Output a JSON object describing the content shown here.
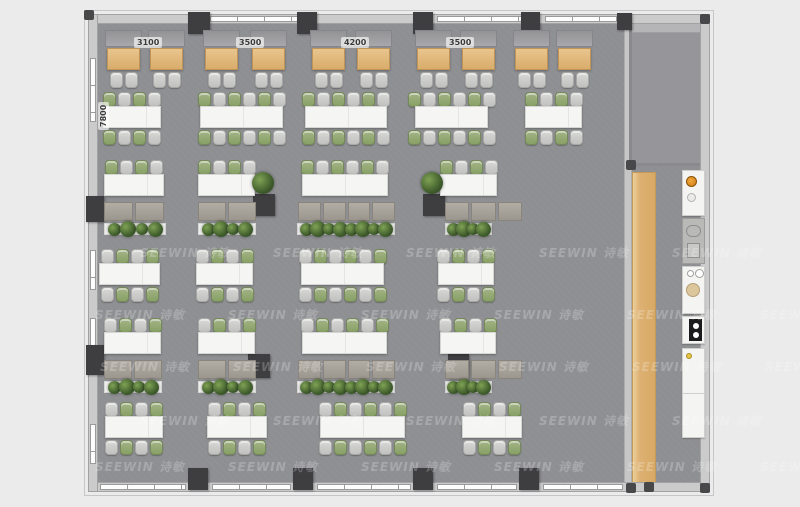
{
  "watermark": {
    "text": "SEEWIN 诗敏",
    "rows": [
      {
        "y": 244,
        "x0": 140
      },
      {
        "y": 306,
        "x0": 95
      },
      {
        "y": 358,
        "x0": 100
      },
      {
        "y": 412,
        "x0": 140
      },
      {
        "y": 458,
        "x0": 95
      }
    ],
    "step": 133,
    "count": 6
  },
  "dimensions": {
    "top": [
      {
        "label": "3100",
        "cx": 147
      },
      {
        "label": "3500",
        "cx": 249
      },
      {
        "label": "4200",
        "cx": 354
      },
      {
        "label": "3500",
        "cx": 459
      }
    ],
    "left": {
      "label": "7800",
      "x": 110,
      "y": 130
    }
  },
  "palette": {
    "floor": "#8e8f92",
    "wall": "#cbcbcb",
    "pillar": "#3e3e40",
    "wood": "#ddb377",
    "chair_green": "#8fa46c",
    "chair_gray": "#c9c9c7",
    "table_white": "#f5f5f4",
    "bench": "#a59f97",
    "watermark_color": "#ffffff"
  },
  "floorplan": {
    "building": {
      "x": 88,
      "y": 14,
      "w": 622,
      "h": 478
    },
    "room": {
      "x": 629,
      "y": 16,
      "w": 78,
      "h": 150
    },
    "bar": {
      "x": 632,
      "y": 172,
      "w": 24,
      "h": 314
    },
    "booths": {
      "benchY": 30,
      "tableY": 48,
      "chairY": 72,
      "tableW": 33,
      "tableH": 22,
      "tables": [
        107,
        150,
        205,
        252,
        312,
        357,
        417,
        462,
        515,
        558
      ]
    },
    "rows": [
      {
        "kind": "double",
        "y": 92,
        "start": "green",
        "groups": [
          {
            "x": 103,
            "w": 58,
            "seats": 4
          },
          {
            "x": 200,
            "w": 83,
            "seats": 6
          },
          {
            "x": 305,
            "w": 82,
            "seats": 6
          },
          {
            "x": 415,
            "w": 73,
            "seats": 6
          },
          {
            "x": 525,
            "w": 57,
            "seats": 4
          }
        ]
      },
      {
        "kind": "lounge",
        "y": 160,
        "start": "green",
        "groups": [
          {
            "x": 104,
            "w": 60,
            "seats": 4,
            "bench": {
              "x": 104,
              "w": 60,
              "panels": 2
            },
            "planter": {
              "x": 104,
              "w": 62,
              "plants": 4
            }
          },
          {
            "x": 198,
            "w": 57,
            "seats": 4,
            "bench": {
              "x": 198,
              "w": 58,
              "panels": 2
            },
            "planter": {
              "x": 198,
              "w": 58,
              "plants": 4
            }
          },
          {
            "x": 302,
            "w": 86,
            "seats": 6,
            "bench": {
              "x": 298,
              "w": 97,
              "panels": 4
            },
            "planter": {
              "x": 297,
              "w": 98,
              "plants": 8
            }
          },
          {
            "x": 440,
            "w": 57,
            "seats": 4,
            "bench": {
              "x": 445,
              "w": 77,
              "panels": 3
            },
            "planter": {
              "x": 445,
              "w": 47,
              "plants": 4
            }
          }
        ]
      },
      {
        "kind": "double",
        "y": 249,
        "start": "gray",
        "groups": [
          {
            "x": 99,
            "w": 61,
            "seats": 4
          },
          {
            "x": 196,
            "w": 57,
            "seats": 4
          },
          {
            "x": 301,
            "w": 83,
            "seats": 6
          },
          {
            "x": 438,
            "w": 56,
            "seats": 4
          }
        ]
      },
      {
        "kind": "lounge",
        "y": 318,
        "start": "gray",
        "groups": [
          {
            "x": 104,
            "w": 57,
            "seats": 4,
            "bench": {
              "x": 104,
              "w": 58,
              "panels": 2
            },
            "planter": {
              "x": 104,
              "w": 58,
              "plants": 4
            }
          },
          {
            "x": 198,
            "w": 57,
            "seats": 4,
            "bench": {
              "x": 198,
              "w": 58,
              "panels": 2
            },
            "planter": {
              "x": 198,
              "w": 58,
              "plants": 4
            }
          },
          {
            "x": 302,
            "w": 85,
            "seats": 6,
            "bench": {
              "x": 298,
              "w": 97,
              "panels": 4
            },
            "planter": {
              "x": 297,
              "w": 98,
              "plants": 8
            }
          },
          {
            "x": 440,
            "w": 56,
            "seats": 4,
            "bench": {
              "x": 445,
              "w": 77,
              "panels": 3
            },
            "planter": {
              "x": 445,
              "w": 47,
              "plants": 4
            }
          }
        ]
      },
      {
        "kind": "double",
        "y": 402,
        "start": "gray",
        "groups": [
          {
            "x": 105,
            "w": 58,
            "seats": 4
          },
          {
            "x": 207,
            "w": 60,
            "seats": 4
          },
          {
            "x": 320,
            "w": 85,
            "seats": 6
          },
          {
            "x": 462,
            "w": 60,
            "seats": 4
          }
        ]
      }
    ],
    "standalone_plants": [
      {
        "cx": 263,
        "cy": 183
      },
      {
        "cx": 432,
        "cy": 183
      }
    ],
    "pillars": [
      [
        188,
        12,
        22,
        22
      ],
      [
        297,
        12,
        20,
        22
      ],
      [
        413,
        12,
        20,
        22
      ],
      [
        521,
        12,
        19,
        22
      ],
      [
        617,
        13,
        15,
        17
      ],
      [
        188,
        468,
        20,
        22
      ],
      [
        293,
        468,
        20,
        22
      ],
      [
        413,
        468,
        20,
        22
      ],
      [
        519,
        468,
        20,
        22
      ],
      [
        86,
        196,
        18,
        26
      ],
      [
        86,
        345,
        18,
        30
      ],
      [
        253,
        194,
        22,
        22
      ],
      [
        423,
        194,
        22,
        22
      ],
      [
        248,
        354,
        22,
        24
      ],
      [
        448,
        354,
        21,
        24
      ]
    ],
    "corner_dots": [
      [
        84,
        10
      ],
      [
        700,
        14
      ],
      [
        626,
        160
      ],
      [
        626,
        483
      ],
      [
        700,
        483
      ],
      [
        644,
        482
      ]
    ],
    "windows": {
      "top": [
        {
          "x": 210,
          "w": 88
        },
        {
          "x": 437,
          "w": 85
        },
        {
          "x": 545,
          "w": 72
        }
      ],
      "bottom": [
        {
          "x": 100,
          "w": 86
        },
        {
          "x": 212,
          "w": 79
        },
        {
          "x": 317,
          "w": 94
        },
        {
          "x": 437,
          "w": 80
        },
        {
          "x": 543,
          "w": 80
        }
      ],
      "left": [
        {
          "y": 58,
          "h": 64
        },
        {
          "y": 250,
          "h": 40
        },
        {
          "y": 318,
          "h": 36
        },
        {
          "y": 424,
          "h": 40
        }
      ]
    }
  },
  "kitchen": {
    "x": 682,
    "w": 23,
    "appliances": [
      {
        "name": "cooktop",
        "y": 170,
        "h": 46,
        "tone": "white"
      },
      {
        "name": "service-counter",
        "y": 218,
        "h": 46,
        "tone": "gray"
      },
      {
        "name": "sink-station",
        "y": 266,
        "h": 48,
        "tone": "white"
      },
      {
        "name": "coffee-machine",
        "y": 316,
        "h": 28,
        "tone": "white"
      },
      {
        "name": "cabinet",
        "y": 348,
        "h": 90,
        "tone": "white"
      }
    ]
  }
}
